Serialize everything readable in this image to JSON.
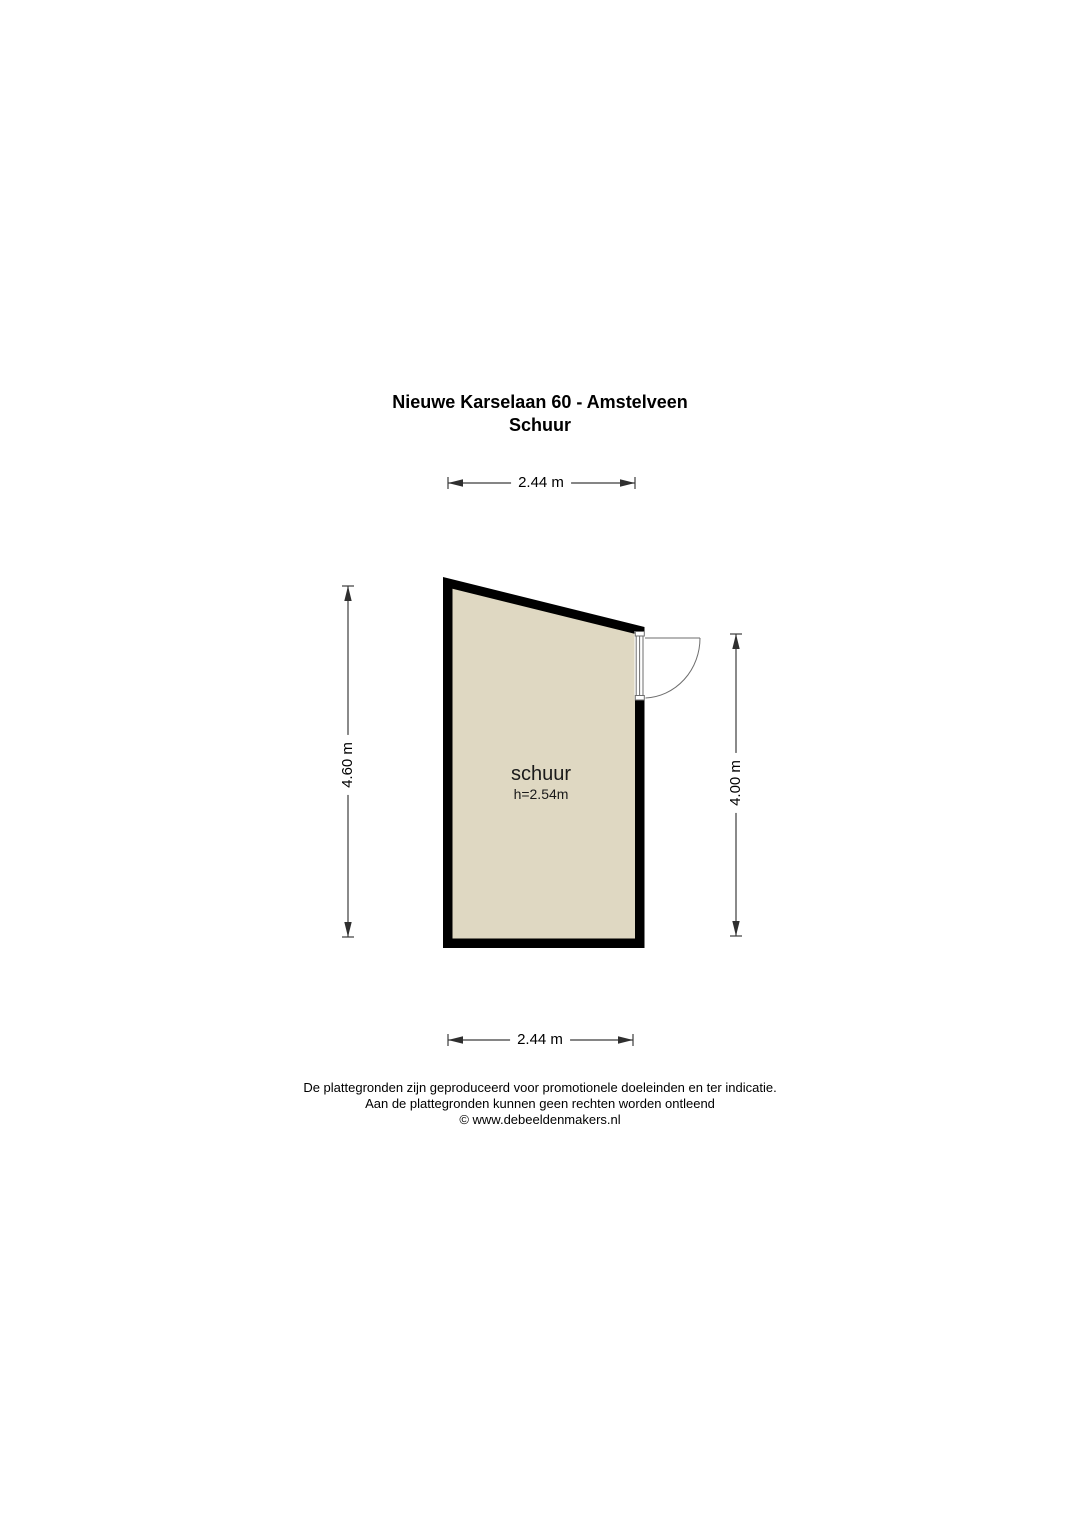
{
  "title": {
    "line1": "Nieuwe Karselaan 60 - Amstelveen",
    "line2": "Schuur"
  },
  "room": {
    "name": "schuur",
    "height_label": "h=2.54m"
  },
  "dimensions": {
    "top": "2.44 m",
    "bottom": "2.44 m",
    "left": "4.60 m",
    "right": "4.00 m"
  },
  "colors": {
    "floor_fill": "#DFD8C2",
    "wall": "#000000",
    "background": "#FFFFFF"
  },
  "footer": {
    "line1": "De plattegronden zijn geproduceerd voor promotionele doeleinden en ter indicatie.",
    "line2": "Aan de plattegronden kunnen geen rechten worden ontleend",
    "line3": "© www.debeeldenmakers.nl"
  }
}
